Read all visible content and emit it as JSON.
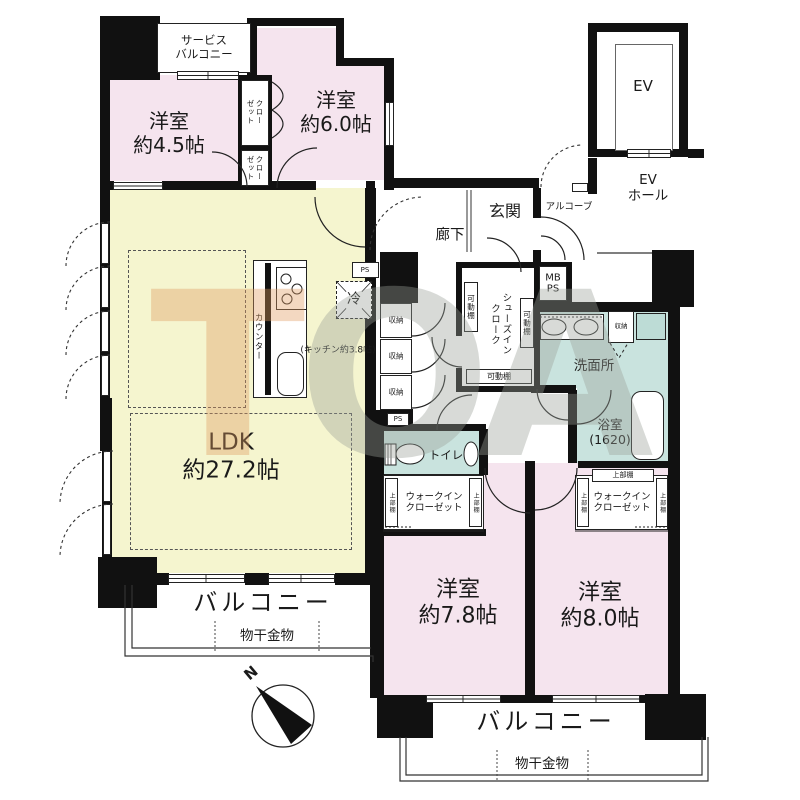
{
  "colors": {
    "wall": "#111111",
    "room_pink": "#f5e4ee",
    "ldk_yellow": "#f5f5cf",
    "wet_teal": "#d3e8e4",
    "watermark_orange": "#e09a5f",
    "watermark_gray": "#9aa098"
  },
  "watermark": {
    "l1": "T",
    "l2": "O",
    "l3": "A"
  },
  "labels": {
    "service_balcony": "サービス\nバルコニー",
    "room_45": "洋室\n約4.5帖",
    "room_60": "洋室\n約6.0帖",
    "closet": "クロー\nゼット",
    "ev": "EV",
    "ev_hall": "EV\nホール",
    "alcove": "アルコーブ",
    "entrance": "玄関",
    "hallway": "廊下",
    "mb_ps": "MB\nPS",
    "ps": "PS",
    "ldk": "LDK\n約27.2帖",
    "kitchen": "(キッチン約3.8帖)",
    "counter": "カウンター",
    "fridge": "冷",
    "storage": "収納",
    "shoes_in_cloak": "シューズイン\nクローク",
    "movable_shelf": "可動棚",
    "washroom": "洗面所",
    "bathroom": "浴室\n(1620)",
    "toilet": "トイレ",
    "wic": "ウォークイン\nクローゼット",
    "upper_shelf": "上部棚",
    "room_78": "洋室\n約7.8帖",
    "room_80": "洋室\n約8.0帖",
    "balcony": "バルコニー",
    "laundry_hardware": "物干金物",
    "north": "N"
  }
}
